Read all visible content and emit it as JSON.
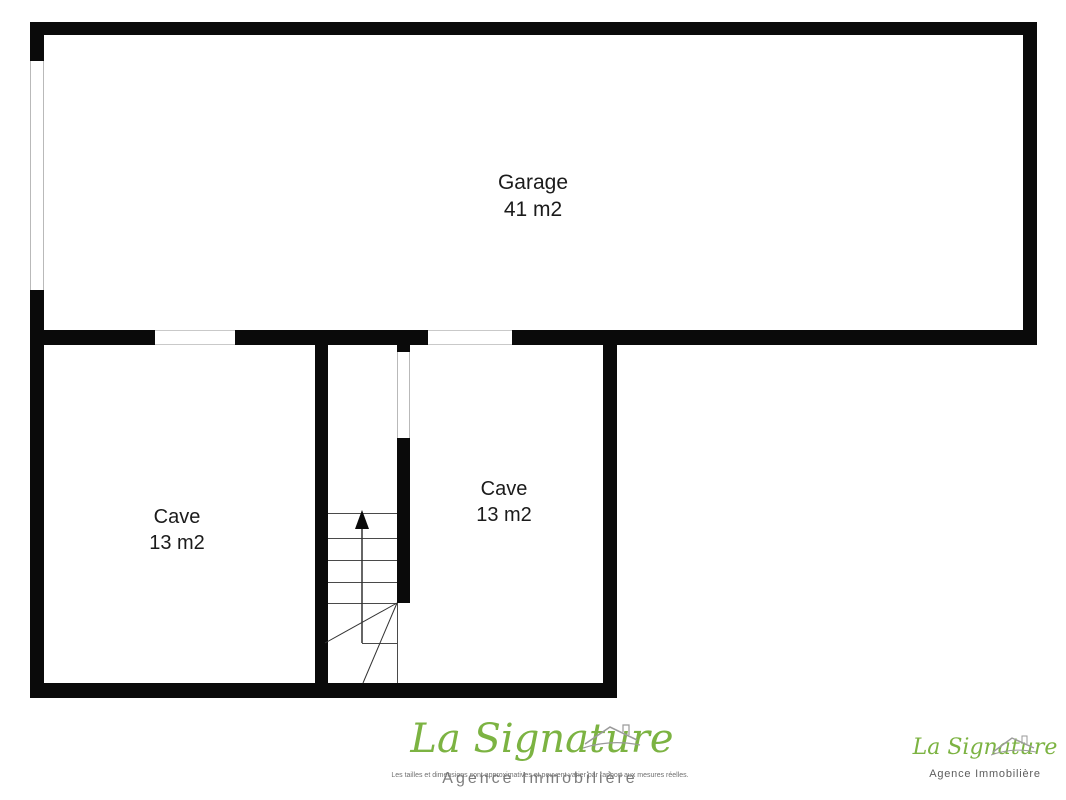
{
  "plan": {
    "garage": {
      "name": "Garage",
      "area": "41 m2"
    },
    "cave_left": {
      "name": "Cave",
      "area": "13 m2"
    },
    "cave_right": {
      "name": "Cave",
      "area": "13 m2"
    }
  },
  "branding": {
    "center": {
      "brand_script": "La Signature",
      "subtitle": "Agence Immobilière",
      "disclaimer": "Les tailles et dimensions sont approximatives et peuvent varier par rapport aux mesures réelles."
    },
    "corner": {
      "brand_script": "La Signature",
      "subtitle": "Agence Immobilière"
    }
  },
  "colors": {
    "wall": "#0a0a0a",
    "label_text": "#1b1b1b",
    "brand_green": "#7cb342",
    "brand_gray": "#5c5c5c"
  }
}
